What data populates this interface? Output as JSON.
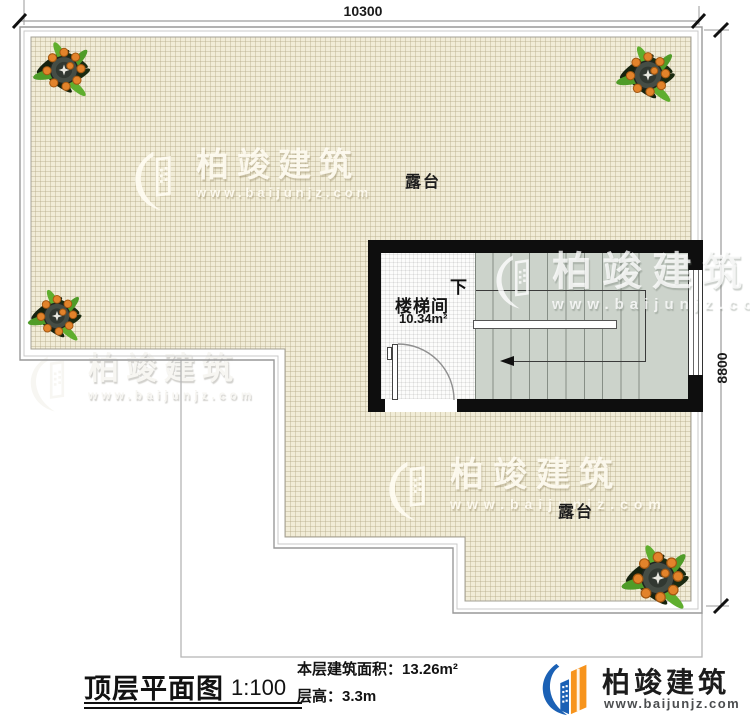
{
  "dimensions": {
    "top": "10300",
    "right": "8800"
  },
  "labels": {
    "terrace_upper": "露台",
    "terrace_lower": "露台"
  },
  "stairwell": {
    "name": "楼梯间",
    "area": "10.34m²",
    "down": "下"
  },
  "watermark": {
    "brand": "柏竣建筑",
    "url": "www.baijunjz.com"
  },
  "title_block": {
    "title": "顶层平面图",
    "scale": "1:100",
    "area_label": "本层建筑面积：",
    "area_value": "13.26m²",
    "height_label": "层高：",
    "height_value": "3.3m"
  },
  "logo": {
    "brand": "柏竣建筑",
    "url": "www.baijunjz.com"
  },
  "colors": {
    "tile": "#f1ecd7",
    "stair_gray": "#ccd3cb",
    "wall_black": "#0e0e0e",
    "logo_blue": "#1b61b5",
    "logo_orange": "#f7941d"
  }
}
